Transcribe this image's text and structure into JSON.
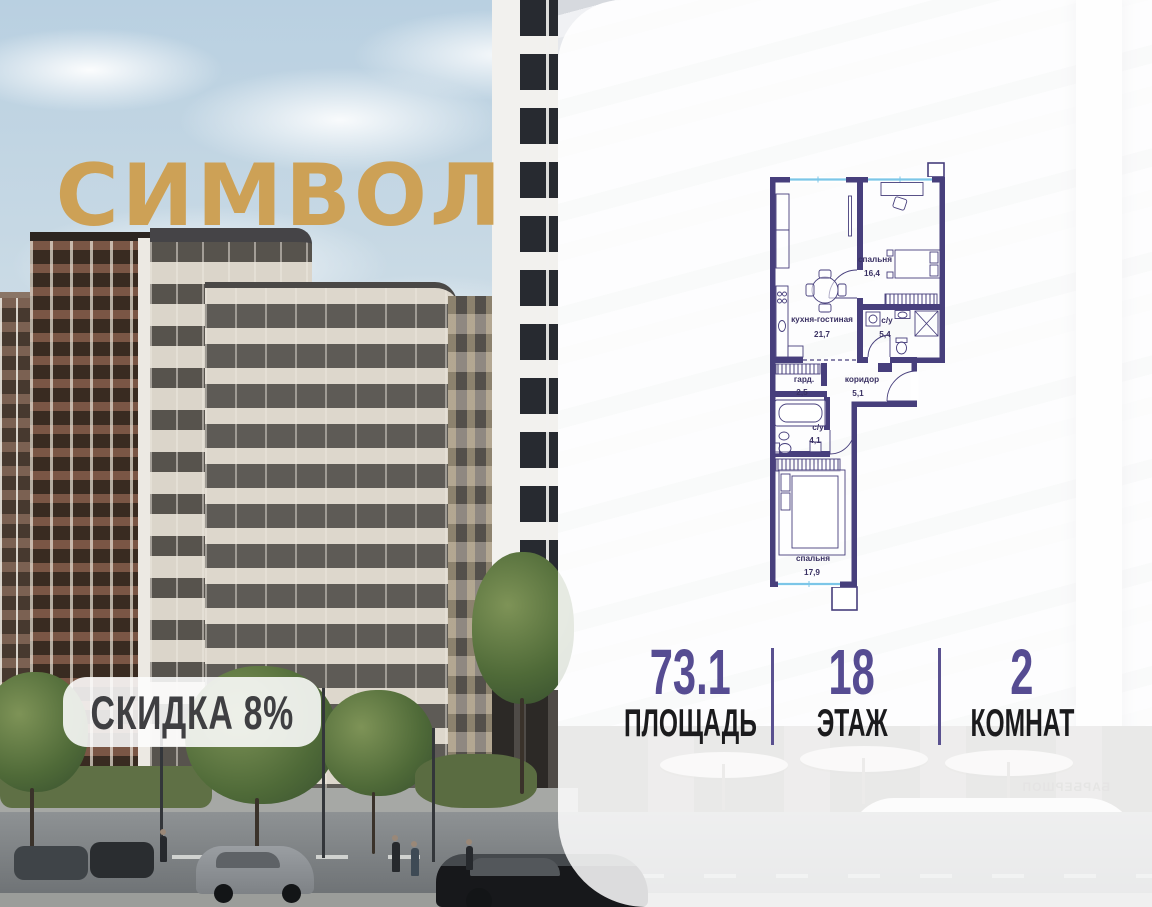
{
  "brand": {
    "logo_text": "СИМВОЛ",
    "logo_color": "#CDA156"
  },
  "badge": {
    "text": "СКИДКА 8%"
  },
  "floor_plan": {
    "rooms": {
      "bedroom1": {
        "name": "спальня",
        "area": "16,4"
      },
      "kitchen_living": {
        "name": "кухня-гостиная",
        "area": "21,7"
      },
      "bathroom1": {
        "name": "с/у",
        "area": "5,4"
      },
      "wardrobe": {
        "name": "гард.",
        "area": "2,5"
      },
      "corridor": {
        "name": "коридор",
        "area": "5,1"
      },
      "bathroom2": {
        "name": "с/у",
        "area": "4,1"
      },
      "bedroom2": {
        "name": "спальня",
        "area": "17,9"
      }
    },
    "wall_color": "#473F7C",
    "window_color": "#7CC6E8"
  },
  "stats": {
    "area": {
      "value": "73.1",
      "label": "ПЛОЩАДЬ"
    },
    "floor": {
      "value": "18",
      "label": "ЭТАЖ"
    },
    "rooms": {
      "value": "2",
      "label": "КОМНАТ"
    }
  },
  "background": {
    "storefront_sign": "БАРБЕРШОП"
  },
  "colors": {
    "accent_purple": "#564C92",
    "divider_purple": "#5A5190"
  }
}
